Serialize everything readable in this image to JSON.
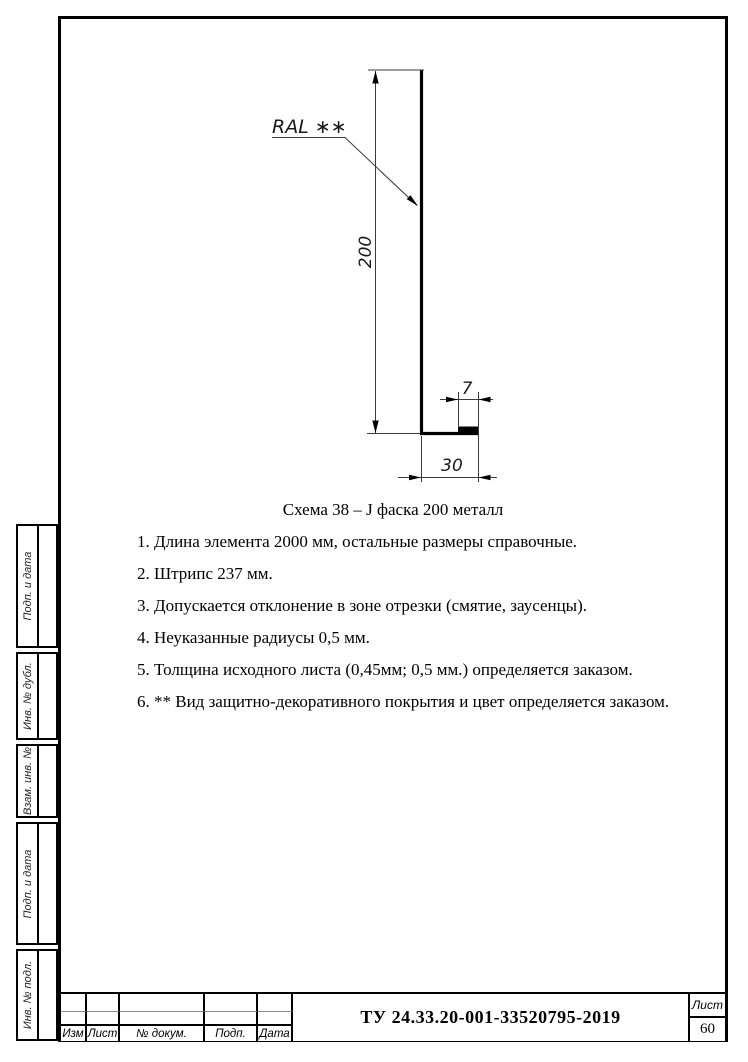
{
  "page": {
    "background": "#ffffff",
    "line_color": "#000000"
  },
  "drawing": {
    "coating_label": "RAL ∗∗",
    "dim_height": "200",
    "dim_hem_width": "7",
    "dim_base_width": "30"
  },
  "caption": "Схема 38 – J фаска 200 металл",
  "notes": [
    "1. Длина элемента 2000 мм, остальные размеры справочные.",
    "2. Штрипс 237 мм.",
    "3. Допускается отклонение в зоне отрезки (смятие, заусенцы).",
    "4. Неуказанные радиусы 0,5 мм.",
    "5. Толщина исходного листа (0,45мм; 0,5 мм.) определяется заказом.",
    "6. ** Вид защитно-декоративного покрытия и цвет определяется заказом."
  ],
  "side_panel": {
    "blocks": [
      {
        "label": "Подп. и дата"
      },
      {
        "label": "Инв. № дубл."
      },
      {
        "label": "Взам. инв. №"
      },
      {
        "label": "Подп. и дата"
      },
      {
        "label": "Инв. № подл."
      }
    ]
  },
  "title_block": {
    "doc_number": "ТУ 24.33.20-001-33520795-2019",
    "sheet_label": "Лист",
    "sheet_number": "60",
    "columns": [
      {
        "label": "Изм"
      },
      {
        "label": "Лист"
      },
      {
        "label": "№ докум."
      },
      {
        "label": "Подп."
      },
      {
        "label": "Дата"
      }
    ]
  }
}
